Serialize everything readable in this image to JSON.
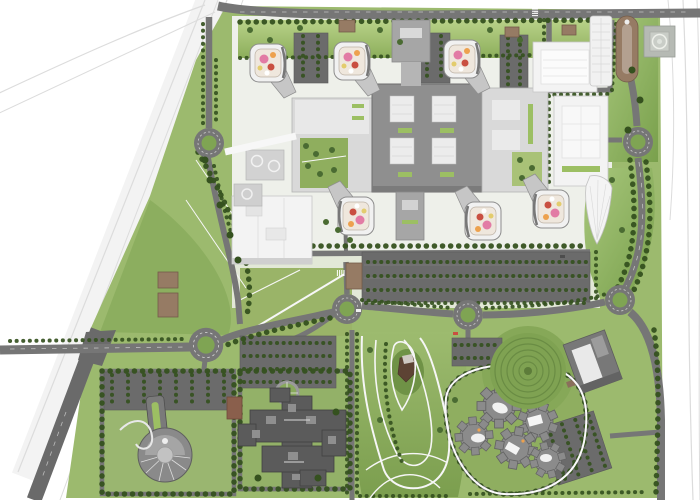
{
  "scene": {
    "kind": "architectural-masterplan-aerial-site-plan",
    "width": 700,
    "height": 500,
    "has_text": false
  },
  "colors": {
    "bg": "#ffffff",
    "ctx": "#dcdcdc",
    "grass": "#9cba6e",
    "grass_mid": "#7fa453",
    "grass_dark": "#5e7f3d",
    "grass_bright": "#b7d189",
    "tree": "#35511f",
    "tree2": "#4a6b32",
    "road": "#767676",
    "road_dark": "#6a6a6a",
    "parking": "#6b6b6b",
    "hardscape": "#eef0ea",
    "bld_white": "#f3f3f3",
    "bld_light": "#d9d9d9",
    "bld_mid": "#a6a6a6",
    "bld_slab": "#8f8f8f",
    "bld_dark": "#5b5b5b",
    "brown": "#967b64",
    "accent_pink": "#e27ba5",
    "accent_orange": "#eda14e",
    "accent_red": "#c94f41",
    "accent_yellow": "#e3cc6d",
    "path": "#f7f7f7"
  },
  "features": {
    "roundabouts": 6,
    "pod_buildings": 6,
    "helipad": 1,
    "central_complex_wings": 3,
    "parking_lots": 8,
    "gear_buildings": 5,
    "terraced_mound": 1,
    "landscaped_park": 1,
    "cross_shaped_complex": 1,
    "keyhole_building": 1,
    "brown_service_huts": 7,
    "context_highways": 2
  }
}
